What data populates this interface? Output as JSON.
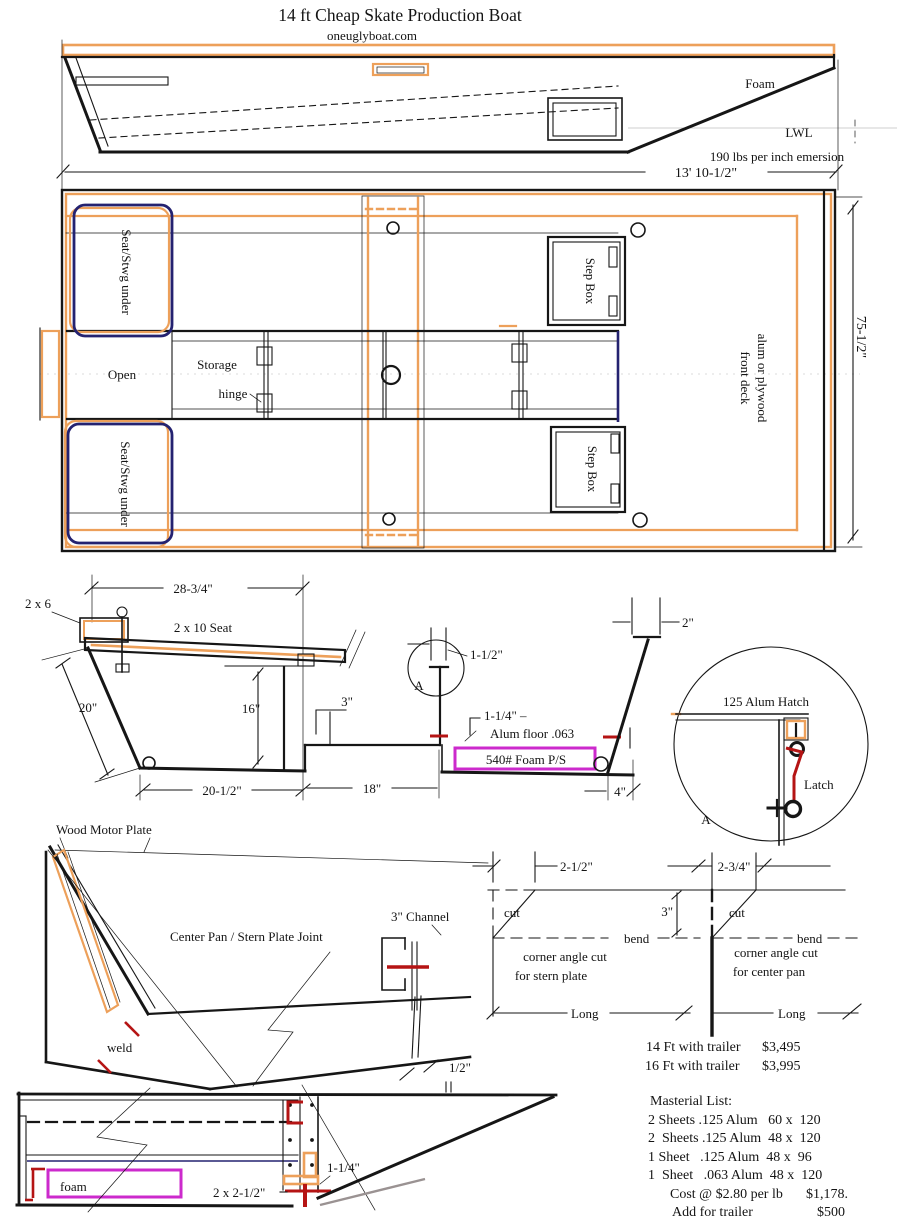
{
  "title": "14 ft Cheap Skate Production Boat",
  "website": "oneuglyboat.com",
  "palette": {
    "line_black": "#161616",
    "accent_orange": "#eda05a",
    "seat_navy": "#242270",
    "foam_magenta": "#cc2acc",
    "weld_red": "#b51414"
  },
  "side_view": {
    "foam_label": "Foam",
    "lwl_label": "LWL",
    "emersion_note": "190 lbs per inch emersion"
  },
  "plan_view": {
    "length_dim": "13' 10-1/2\"",
    "beam_dim": "75-1/2\"",
    "seat_front_label": "Seat/Stwg under",
    "seat_rear_label": "Seat/Stwg under",
    "open_label": "Open",
    "storage_label": "Storage",
    "hinge_label": "hinge",
    "step_box_front": "Step Box",
    "step_box_rear": "Step Box",
    "front_deck_line1": "front deck",
    "front_deck_line2": "alum or plywood"
  },
  "cross_section": {
    "seat_width_dim": "28-3/4\"",
    "cleat_label": "2 x 6",
    "seat_label": "2 x 10 Seat",
    "side_dim": "20\"",
    "depth_dim": "16\"",
    "step_dim": "3\"",
    "bottom_dim": "20-1/2\"",
    "floor_dim": "18\"",
    "rib_dim": "1-1/2\"",
    "detail_marker": "A",
    "lip_dim": "1-1/4\" –",
    "floor_label": "Alum floor .063",
    "foam_label": "540# Foam P/S",
    "recess_dim": "4\"",
    "gunwale_dim": "2\""
  },
  "hatch_detail": {
    "hatch_label": "125 Alum Hatch",
    "latch_label": "Latch",
    "detail_marker": "A"
  },
  "stern_detail": {
    "motor_plate_label": "Wood Motor Plate",
    "joint_label": "Center Pan / Stern Plate Joint",
    "channel_label": "3\" Channel",
    "weld_label": "weld",
    "gap_dim": "1/2\""
  },
  "corner_cut_left": {
    "offset_dim": "2-1/2\"",
    "cut_label": "cut",
    "depth_dim": "3\"",
    "bend_label": "bend",
    "caption_line1": "corner angle cut",
    "caption_line2": "for stern plate",
    "long_label": "Long"
  },
  "corner_cut_right": {
    "offset_dim": "2-3/4\"",
    "cut_label": "cut",
    "bend_label": "bend",
    "caption_line1": "corner angle cut",
    "caption_line2": "for center pan",
    "long_label": "Long"
  },
  "pricing": [
    {
      "item": "14 Ft with trailer",
      "price": "$3,495"
    },
    {
      "item": "16 Ft with trailer",
      "price": "$3,995"
    }
  ],
  "materials": {
    "heading": "Masterial List:",
    "items": [
      "2 Sheets .125 Alum   60 x  120",
      "2  Sheets .125 Alum  48 x  120",
      "1 Sheet   .125 Alum  48 x  96",
      "1  Sheet   .063 Alum  48 x  120"
    ],
    "cost_label": "Cost @ $2.80 per lb",
    "cost_value": "$1,178.",
    "trailer_label": "Add for trailer",
    "trailer_value": "$500"
  },
  "stern_side_view": {
    "foam_label": "foam",
    "frame_dim": "2 x 2-1/2\"",
    "channel_dim": "1-1/4\""
  }
}
